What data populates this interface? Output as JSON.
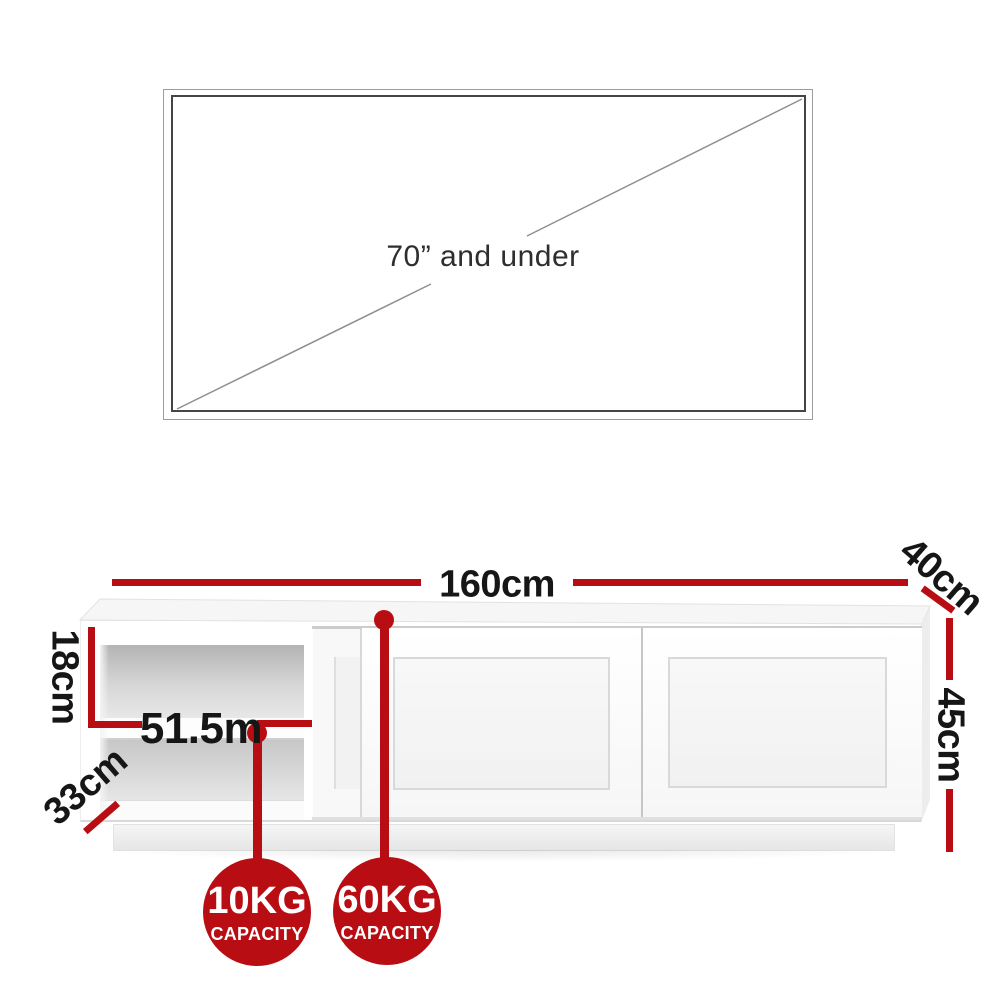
{
  "tv_size_guide": {
    "text": "70” and under"
  },
  "dimensions": {
    "width_label": "160cm",
    "depth_label": "40cm",
    "height_label": "45cm",
    "open_shelf_height_label": "18cm",
    "open_shelf_width_label": "51.5m",
    "open_shelf_depth_label": "33cm"
  },
  "capacity_badges": [
    {
      "value": "10KG",
      "unit_label": "CAPACITY"
    },
    {
      "value": "60KG",
      "unit_label": "CAPACITY"
    }
  ],
  "colors": {
    "accent_red": "#b80e13",
    "label_black": "#161616",
    "tv_outline_dark": "#454545",
    "tv_outline_light": "#9c9c9c",
    "diagonal_gray": "#8f8f8f"
  }
}
